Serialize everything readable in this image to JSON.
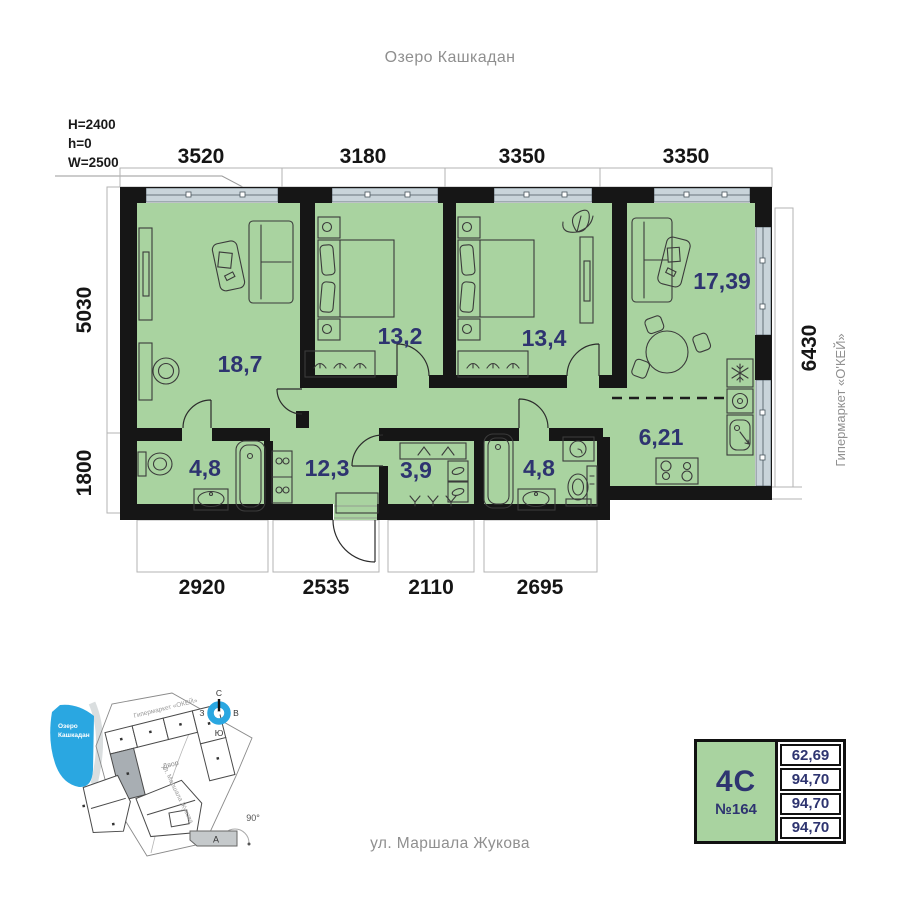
{
  "labels": {
    "lake_top": "Озеро Кашкадан",
    "street_bottom": "ул. Маршала Жукова",
    "hypermarket_right": "Гипермаркет «О'КЕЙ»"
  },
  "window_specs": {
    "height": "H=2400",
    "sill": "h=0",
    "width": "W=2500"
  },
  "dims": {
    "top": [
      "3520",
      "3180",
      "3350",
      "3350"
    ],
    "bottom": [
      "2920",
      "2535",
      "2110",
      "2695"
    ],
    "left": [
      "5030",
      "1800"
    ],
    "right": [
      "6430"
    ]
  },
  "rooms": {
    "living": "18,7",
    "bedroom1": "13,2",
    "bedroom2": "13,4",
    "kitchen_living": "17,39",
    "kitchen": "6,21",
    "bathroom1": "4,8",
    "hallway": "12,3",
    "wardrobe": "3,9",
    "bathroom2": "4,8"
  },
  "minimap": {
    "lake_line1": "Озеро",
    "lake_line2": "Кашкадан",
    "hypermarket": "Гипермаркет «ОКЕЙ»",
    "courtyard": "Двор",
    "street": "ул. Маршала Жукова",
    "angle": "90°",
    "section": "А",
    "compass": {
      "n": "С",
      "s": "Ю",
      "w": "З",
      "e": "В"
    }
  },
  "card": {
    "type": "4С",
    "number": "№164",
    "values": [
      "62,69",
      "94,70",
      "94,70",
      "94,70"
    ]
  },
  "colors": {
    "room_fill": "#a9d3a0",
    "wall": "#161616",
    "accent_blue": "#2aa7e1",
    "label_navy": "#2e3470",
    "glazing": "#c9d4da",
    "muted_text": "#8f8f8f"
  }
}
